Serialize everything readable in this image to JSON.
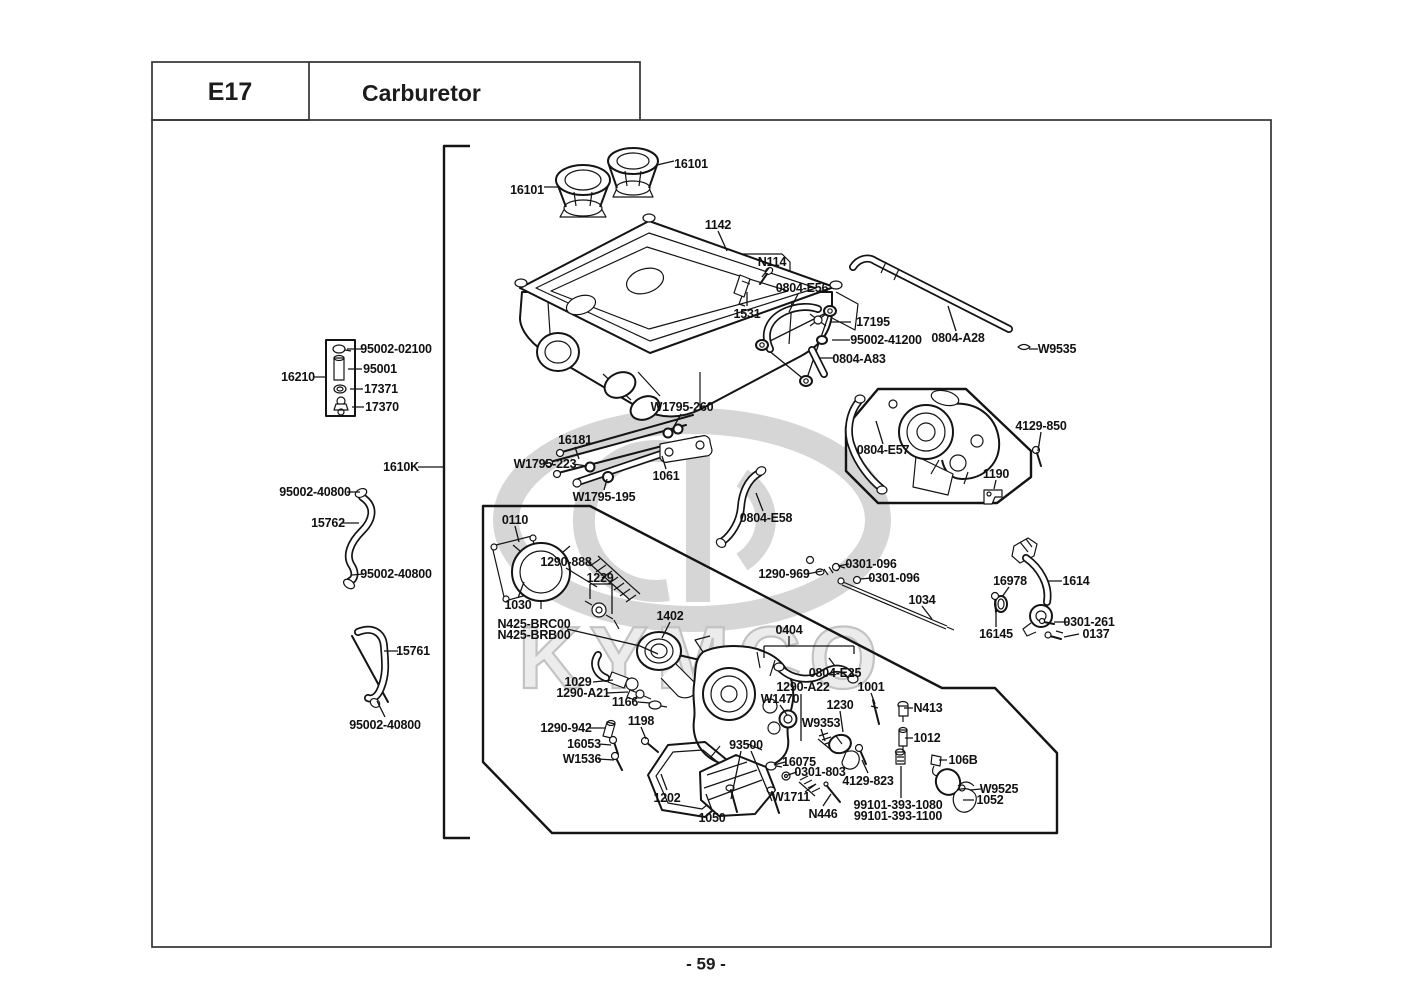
{
  "header": {
    "code": "E17",
    "title": "Carburetor"
  },
  "footer": {
    "page_number": "- 59 -"
  },
  "watermark": {
    "brand": "KYMCO"
  },
  "parts": [
    {
      "label": "16101",
      "x": 527,
      "y": 190
    },
    {
      "label": "16101",
      "x": 691,
      "y": 164
    },
    {
      "label": "1142",
      "x": 718,
      "y": 225
    },
    {
      "label": "N114",
      "x": 772,
      "y": 262
    },
    {
      "label": "1531",
      "x": 747,
      "y": 314
    },
    {
      "label": "0804-E56",
      "x": 802,
      "y": 288
    },
    {
      "label": "17195",
      "x": 873,
      "y": 322
    },
    {
      "label": "95002-41200",
      "x": 886,
      "y": 340
    },
    {
      "label": "0804-A83",
      "x": 859,
      "y": 359
    },
    {
      "label": "0804-A28",
      "x": 958,
      "y": 338
    },
    {
      "label": "W9535",
      "x": 1057,
      "y": 349
    },
    {
      "label": "95002-02100",
      "x": 396,
      "y": 349
    },
    {
      "label": "95001",
      "x": 380,
      "y": 369
    },
    {
      "label": "17371",
      "x": 381,
      "y": 389
    },
    {
      "label": "17370",
      "x": 382,
      "y": 407
    },
    {
      "label": "16210",
      "x": 298,
      "y": 377
    },
    {
      "label": "W1795-260",
      "x": 682,
      "y": 407
    },
    {
      "label": "16181",
      "x": 575,
      "y": 440
    },
    {
      "label": "W1795-223",
      "x": 545,
      "y": 464
    },
    {
      "label": "W1795-195",
      "x": 604,
      "y": 497
    },
    {
      "label": "1061",
      "x": 666,
      "y": 476
    },
    {
      "label": "1610K",
      "x": 401,
      "y": 467
    },
    {
      "label": "95002-40800",
      "x": 315,
      "y": 492
    },
    {
      "label": "15762",
      "x": 328,
      "y": 523
    },
    {
      "label": "95002-40800",
      "x": 396,
      "y": 574
    },
    {
      "label": "15761",
      "x": 413,
      "y": 651
    },
    {
      "label": "95002-40800",
      "x": 385,
      "y": 725
    },
    {
      "label": "0804-E57",
      "x": 883,
      "y": 450
    },
    {
      "label": "4129-850",
      "x": 1041,
      "y": 426
    },
    {
      "label": "1190",
      "x": 996,
      "y": 474
    },
    {
      "label": "0110",
      "x": 515,
      "y": 520
    },
    {
      "label": "1290-888",
      "x": 566,
      "y": 562
    },
    {
      "label": "1229",
      "x": 600,
      "y": 578
    },
    {
      "label": "1030",
      "x": 518,
      "y": 605
    },
    {
      "label": "N425-BRC00",
      "x": 534,
      "y": 624
    },
    {
      "label": "N425-BRB00",
      "x": 534,
      "y": 635
    },
    {
      "label": "1402",
      "x": 670,
      "y": 616
    },
    {
      "label": "0804-E58",
      "x": 766,
      "y": 518
    },
    {
      "label": "1290-969",
      "x": 784,
      "y": 574
    },
    {
      "label": "0301-096",
      "x": 871,
      "y": 564
    },
    {
      "label": "0301-096",
      "x": 894,
      "y": 578
    },
    {
      "label": "1034",
      "x": 922,
      "y": 600
    },
    {
      "label": "16978",
      "x": 1010,
      "y": 581
    },
    {
      "label": "1614",
      "x": 1076,
      "y": 581
    },
    {
      "label": "16145",
      "x": 996,
      "y": 634
    },
    {
      "label": "0301-261",
      "x": 1089,
      "y": 622
    },
    {
      "label": "0137",
      "x": 1096,
      "y": 634
    },
    {
      "label": "0404",
      "x": 789,
      "y": 630
    },
    {
      "label": "0804-E25",
      "x": 835,
      "y": 673
    },
    {
      "label": "1029",
      "x": 578,
      "y": 682
    },
    {
      "label": "1290-A21",
      "x": 583,
      "y": 693
    },
    {
      "label": "1166",
      "x": 625,
      "y": 702
    },
    {
      "label": "1290-942",
      "x": 566,
      "y": 728
    },
    {
      "label": "1198",
      "x": 641,
      "y": 721
    },
    {
      "label": "16053",
      "x": 584,
      "y": 744
    },
    {
      "label": "W1536",
      "x": 582,
      "y": 759
    },
    {
      "label": "1202",
      "x": 667,
      "y": 798
    },
    {
      "label": "1050",
      "x": 712,
      "y": 818
    },
    {
      "label": "93500",
      "x": 746,
      "y": 745
    },
    {
      "label": "16075",
      "x": 799,
      "y": 762
    },
    {
      "label": "0301-803",
      "x": 820,
      "y": 772
    },
    {
      "label": "W1711",
      "x": 791,
      "y": 797
    },
    {
      "label": "N446",
      "x": 823,
      "y": 814
    },
    {
      "label": "4129-823",
      "x": 868,
      "y": 781
    },
    {
      "label": "99101-393-1080",
      "x": 898,
      "y": 805
    },
    {
      "label": "99101-393-1100",
      "x": 898,
      "y": 816
    },
    {
      "label": "1290-A22",
      "x": 803,
      "y": 687
    },
    {
      "label": "W1470",
      "x": 780,
      "y": 699
    },
    {
      "label": "1230",
      "x": 840,
      "y": 705
    },
    {
      "label": "W9353",
      "x": 821,
      "y": 723
    },
    {
      "label": "1001",
      "x": 871,
      "y": 687
    },
    {
      "label": "N413",
      "x": 928,
      "y": 708
    },
    {
      "label": "1012",
      "x": 927,
      "y": 738
    },
    {
      "label": "106B",
      "x": 963,
      "y": 760
    },
    {
      "label": "W9525",
      "x": 999,
      "y": 789
    },
    {
      "label": "1052",
      "x": 990,
      "y": 800
    }
  ]
}
